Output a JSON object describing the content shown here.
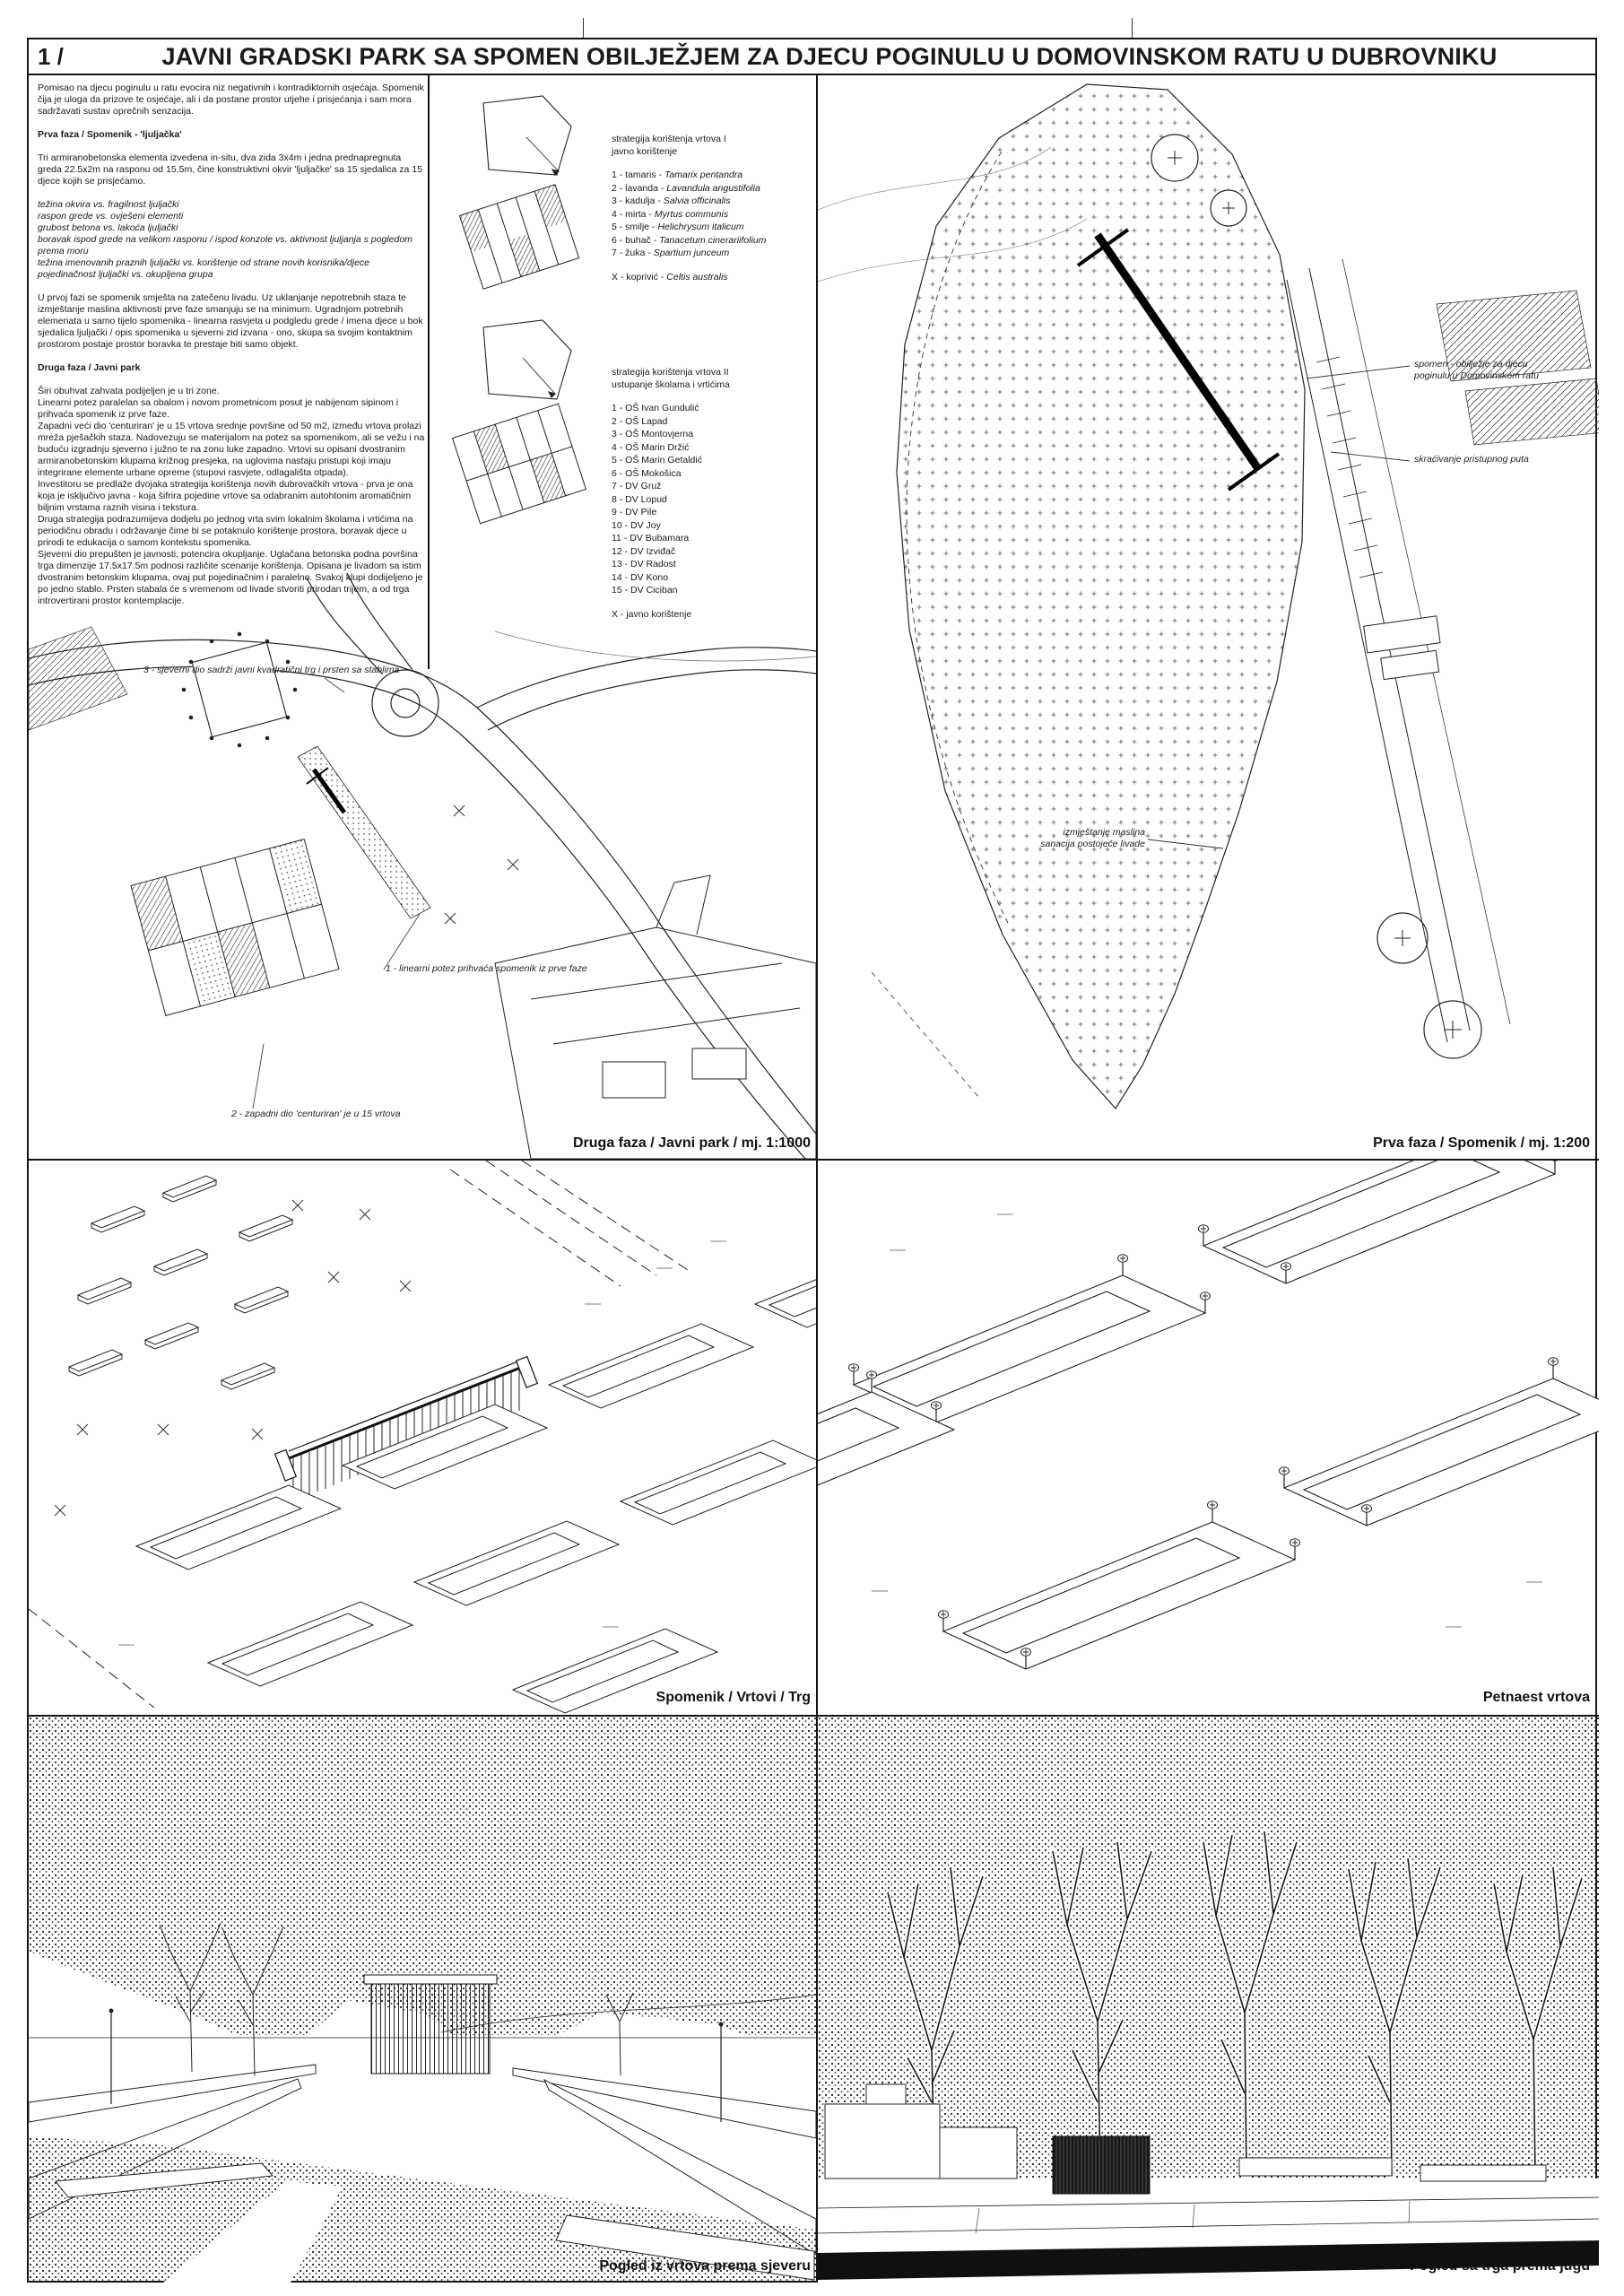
{
  "title": {
    "index": "1 /",
    "text": "JAVNI GRADSKI PARK SA SPOMEN OBILJEŽJEM ZA DJECU POGINULU U DOMOVINSKOM RATU U DUBROVNIKU"
  },
  "intro": "Pomisao na djecu poginulu u ratu evocira niz negativnih i kontradiktornih osjećaja. Spomenik čija je uloga da prizove te osjećaje, ali i da postane prostor utjehe i prisjećanja i sam mora sadržavati sustav oprečnih senzacija.",
  "phase1": {
    "heading": "Prva faza / Spomenik - 'ljuljačka'",
    "body": "Tri armiranobetonska elementa izvedena in-situ, dva zida 3x4m i jedna prednapregnuta greda 22.5x2m na rasponu od 15.5m, čine konstruktivni okvir 'ljuljačke' sa 15 sjedalica za 15 djece kojih se prisjećamo.",
    "contrasts": "težina okvira vs. fragilnost ljuljački\nraspon grede vs. ovješeni elementi\ngrubost betona vs. lakoća ljuljački\nboravak ispod grede na velikom rasponu / ispod konzole vs. aktivnost ljuljanja s pogledom prema moru\ntežina imenovanih praznih ljuljački vs. korištenje od strane novih korisnika/djece\npojedinačnost ljuljački vs. okupljena grupa",
    "body2": "U prvoj fazi se spomenik smješta na zatečenu livadu. Uz uklanjanje nepotrebnih staza te izmještanje maslina aktivnosti prve faze smanjuju se na minimum. Ugradnjom potrebnih elemenata u samo tijelo spomenika - linearna rasvjeta u podgledu grede / imena djece u bok sjedalica ljuljački / opis spomenika u sjeverni zid izvana - ono, skupa sa svojim kontaktnim prostorom postaje prostor boravka te prestaje biti samo objekt."
  },
  "phase2": {
    "heading": "Druga faza / Javni park",
    "body": "Širi obuhvat zahvata podijeljen je u tri zone.\nLinearni potez paralelan sa obalom i novom prometnicom posut je nabijenom sipinom i prihvaća spomenik iz prve faze.\nZapadni veći dio 'centuriran' je u 15 vrtova srednje površine od 50 m2, između vrtova prolazi mreža pješačkih staza. Nadovezuju se materijalom na potez sa spomenikom, ali se vežu i na buduću izgradnju sjeverno i južno te na zonu luke zapadno. Vrtovi su opisani dvostranim armiranobetonskim klupama križnog presjeka, na uglovima nastaju pristupi koji imaju integrirane elemente urbane opreme (stupovi rasvjete, odlagališta otpada).\nInvestitoru se predlaže dvojaka strategija korištenja novih dubrovačkih vrtova - prva je ona koja je isključivo javna - koja šifrira pojedine vrtove sa odabranim autohtonim aromatičnim biljnim vrstama raznih visina i tekstura.\nDruga strategija podrazumijeva dodjelu po jednog vrta svim lokalnim školama i vrtićima na periodičnu obradu i održavanje čime bi se potaknulo korištenje prostora, boravak djece u prirodi te edukacija o samom kontekstu spomenika.\nSjeverni dio prepušten je javnosti, potencira okupljanje. Uglačana betonska podna površina trga dimenzije 17.5x17.5m podnosi različite scenarije korištenja. Opisana je livadom sa istim dvostranim betonskim klupama, ovaj put pojedinačnim i paralelno. Svakoj klupi dodijeljeno je po jedno stablo. Prsten stabala će s vremenom od livade stvoriti prirodan trijem, a od trga introvertirani prostor kontemplacije."
  },
  "strategy1": {
    "title": "strategija korištenja vrtova I\njavno korištenje",
    "plants": [
      {
        "label": "1 - tamaris",
        "latin": "Tamarix pentandra"
      },
      {
        "label": "2 - lavanda",
        "latin": "Lavandula angustifolia"
      },
      {
        "label": "3 - kadulja",
        "latin": "Salvia officinalis"
      },
      {
        "label": "4 - mirta",
        "latin": "Myrtus communis"
      },
      {
        "label": "5 - smilje",
        "latin": "Helichrysum italicum"
      },
      {
        "label": "6 - buhač",
        "latin": "Tanacetum cinerariifolium"
      },
      {
        "label": "7 - žuka",
        "latin": "Spartium junceum"
      }
    ],
    "extra_list": [
      {
        "label": "X - koprivić",
        "latin": "Celtis australis"
      }
    ]
  },
  "strategy2": {
    "title": "strategija korištenja vrtova II\nustupanje školama i vrtićima",
    "schools": [
      "1 - OŠ Ivan Gundulić",
      "2 - OŠ Lapad",
      "3 - OŠ Montovjerna",
      "4 - OŠ Marin Držić",
      "5 - OŠ Marin Getaldić",
      "6 - OŠ Mokošica",
      "7 - DV Gruž",
      "8 - DV Lopud",
      "9 - DV Pile",
      "10 - DV Joy",
      "11 - DV Bubamara",
      "12 - DV Izviđač",
      "13 - DV Radost",
      "14 - DV Kono",
      "15 - DV Ciciban"
    ],
    "extra_list": [
      "X - javno korištenje"
    ]
  },
  "plan2": {
    "caption": "Druga faza / Javni park / mj. 1:1000",
    "label_zone3": "3 - sjeverni dio sadrži javni kvadratični trg i prsten sa stablima",
    "label_zone1": "1 - linearni potez prihvaća spomenik iz prve faze",
    "label_zone2": "2 - zapadni dio 'centuriran' je u 15 vrtova"
  },
  "plan1": {
    "caption": "Prva faza / Spomenik / mj. 1:200",
    "label_monument": "spomen - obilježje za djecu\npoginulu u Domovinskom ratu",
    "label_path": "skraćivanje pristupnog puta",
    "label_olives": "izmještanje maslina\nsanacija postojeće livade"
  },
  "axon_left": {
    "caption": "Spomenik / Vrtovi / Trg"
  },
  "axon_right": {
    "caption": "Petnaest vrtova"
  },
  "view_left": {
    "caption": "Pogled iz vrtova prema sjeveru"
  },
  "view_right": {
    "caption": "Pogled sa trga prema jugu"
  },
  "colors": {
    "ink": "#1a1a1a",
    "line": "#333333",
    "background": "#ffffff"
  }
}
